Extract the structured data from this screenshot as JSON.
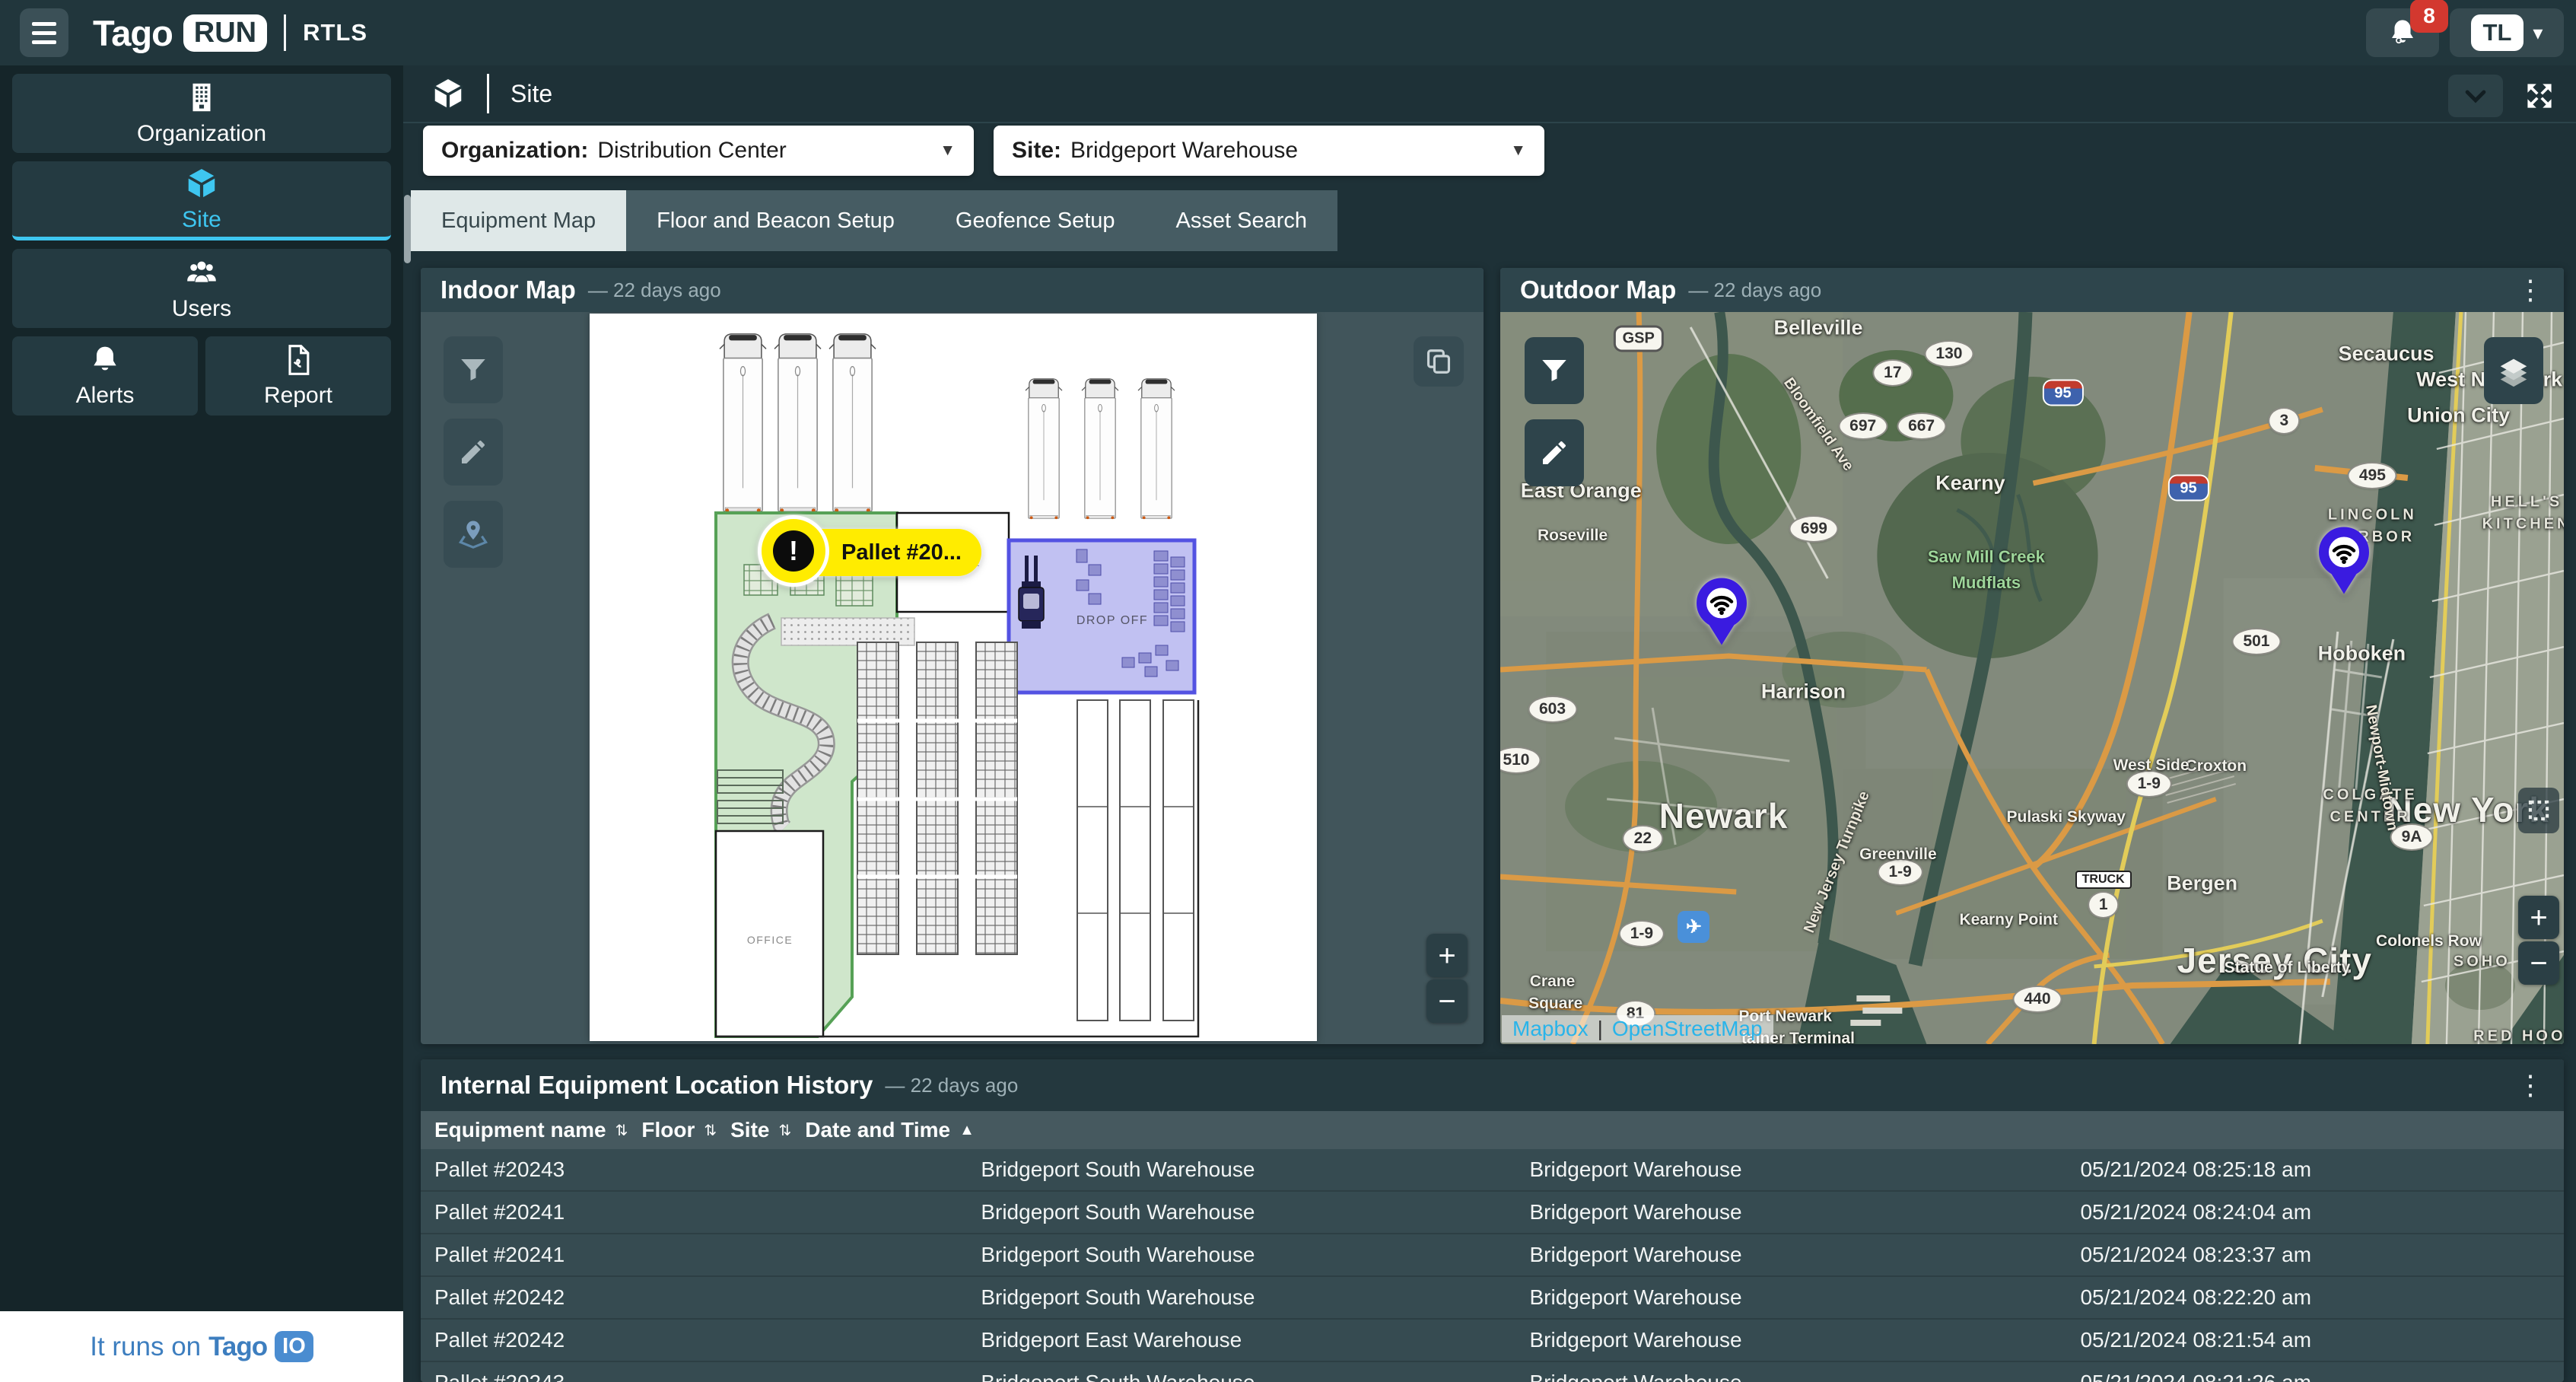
{
  "colors": {
    "accent_cyan": "#3ec6f0",
    "badge_red": "#d3382f",
    "pin_blue": "#3a1be0",
    "tago_blue": "#3d7ebf",
    "link_cyan": "#29b4ea",
    "zone_green": "#cfe6cb",
    "zone_purple": "#b6b6ef",
    "alert_yellow": "#ffec00"
  },
  "icons": {
    "kebab": "⋮",
    "caret_down": "▾",
    "dd_caret": "▼"
  },
  "topbar": {
    "logo_text": "Tago",
    "logo_badge": "RUN",
    "product": "RTLS",
    "notif_count": "8",
    "user_initials": "TL"
  },
  "sidebar": {
    "items": [
      {
        "label": "Organization"
      },
      {
        "label": "Site"
      },
      {
        "label": "Users"
      }
    ],
    "alerts_label": "Alerts",
    "report_label": "Report",
    "footer": {
      "prefix": "It runs on",
      "brand": "Tago",
      "badge": "IO"
    }
  },
  "header": {
    "title": "Site"
  },
  "filters": {
    "org_label": "Organization:",
    "org_value": "Distribution Center",
    "site_label": "Site:",
    "site_value": "Bridgeport Warehouse"
  },
  "tabs": [
    {
      "label": "Equipment Map",
      "cls": "active"
    },
    {
      "label": "Floor and Beacon Setup"
    },
    {
      "label": "Geofence Setup"
    },
    {
      "label": "Asset Search"
    }
  ],
  "indoor": {
    "title": "Indoor Map",
    "updated": "— 22 days ago",
    "alert_label": "Pallet #20...",
    "zones": {
      "loading": "LOADING",
      "lounge": "LOUNGE",
      "dropoff": "DROP OFF",
      "office": "OFFICE"
    },
    "zoom_in": "+",
    "zoom_out": "−"
  },
  "outdoor": {
    "title": "Outdoor Map",
    "updated": "— 22 days ago",
    "attribution": {
      "a": "Mapbox",
      "sep": "|",
      "b": "OpenStreetMap"
    },
    "zoom_in": "+",
    "zoom_out": "−",
    "pins": [
      {
        "x": 20.8,
        "y": 44.4
      },
      {
        "x": 79.3,
        "y": 37.4
      }
    ],
    "labels": [
      {
        "text": "GSP",
        "x": 13,
        "y": 3.6,
        "cls": "gsp"
      },
      {
        "text": "Belleville",
        "x": 29.9,
        "y": 2.2,
        "cls": "place"
      },
      {
        "text": "130",
        "x": 42.2,
        "y": 5.7,
        "cls": "shield"
      },
      {
        "text": "17",
        "x": 36.9,
        "y": 8.3,
        "cls": "shield"
      },
      {
        "text": "95",
        "x": 52.9,
        "y": 11,
        "cls": "interstate"
      },
      {
        "text": "Secaucus",
        "x": 83.3,
        "y": 5.7,
        "cls": "place"
      },
      {
        "text": "West New York",
        "x": 93,
        "y": 9.3,
        "cls": "place"
      },
      {
        "text": "Union City",
        "x": 90.1,
        "y": 14.1,
        "cls": "place"
      },
      {
        "text": "3",
        "x": 73.7,
        "y": 14.9,
        "cls": "shield"
      },
      {
        "text": "667",
        "x": 39.6,
        "y": 15.6,
        "cls": "shield"
      },
      {
        "text": "697",
        "x": 34.1,
        "y": 15.6,
        "cls": "shield"
      },
      {
        "text": "East Orange",
        "x": 7.6,
        "y": 24.4,
        "cls": "place"
      },
      {
        "text": "Kearny",
        "x": 44.2,
        "y": 23.4,
        "cls": "place"
      },
      {
        "text": "95",
        "x": 64.7,
        "y": 24,
        "cls": "interstate"
      },
      {
        "text": "495",
        "x": 82,
        "y": 22.3,
        "cls": "shield"
      },
      {
        "text": "LINCOLN",
        "x": 82,
        "y": 27.8,
        "cls": "caps"
      },
      {
        "text": "HARBOR",
        "x": 82,
        "y": 30.8,
        "cls": "caps"
      },
      {
        "text": "HELL'S",
        "x": 96.5,
        "y": 26,
        "cls": "caps"
      },
      {
        "text": "KITCHEN",
        "x": 96.5,
        "y": 29,
        "cls": "caps"
      },
      {
        "text": "699",
        "x": 29.5,
        "y": 29.6,
        "cls": "shield"
      },
      {
        "text": "Roseville",
        "x": 6.8,
        "y": 30.6,
        "cls": "place-sm"
      },
      {
        "text": "Saw Mill Creek",
        "x": 45.7,
        "y": 33.5,
        "cls": "water-label"
      },
      {
        "text": "Mudflats",
        "x": 45.7,
        "y": 37,
        "cls": "water-label"
      },
      {
        "text": "Bloomfield Ave",
        "x": 29.9,
        "y": 15.4,
        "cls": "road-label",
        "rot": 55
      },
      {
        "text": "Harrison",
        "x": 28.5,
        "y": 51.9,
        "cls": "place"
      },
      {
        "text": "Newark",
        "x": 21,
        "y": 68.8,
        "cls": "place-lg"
      },
      {
        "text": "501",
        "x": 71.1,
        "y": 45,
        "cls": "shield"
      },
      {
        "text": "1-9",
        "x": 61,
        "y": 64.4,
        "cls": "shield"
      },
      {
        "text": "1-9",
        "x": 37.6,
        "y": 76.5,
        "cls": "shield"
      },
      {
        "text": "1-9",
        "x": 13.3,
        "y": 84.9,
        "cls": "shield"
      },
      {
        "text": "Croxton",
        "x": 67.3,
        "y": 62.1,
        "cls": "place-sm"
      },
      {
        "text": "Pulaski Skyway",
        "x": 53.2,
        "y": 69,
        "cls": "place-sm"
      },
      {
        "text": "TRUCK",
        "x": 56.7,
        "y": 77.5,
        "cls": "truckshield"
      },
      {
        "text": "1",
        "x": 56.7,
        "y": 81,
        "cls": "shield"
      },
      {
        "text": "Kearny Point",
        "x": 47.8,
        "y": 83.1,
        "cls": "place-sm"
      },
      {
        "text": "Bergen",
        "x": 66,
        "y": 78.1,
        "cls": "place"
      },
      {
        "text": "Jersey City",
        "x": 72.8,
        "y": 88.6,
        "cls": "place-lg"
      },
      {
        "text": "Hoboken",
        "x": 81,
        "y": 46.7,
        "cls": "place"
      },
      {
        "text": "New York",
        "x": 91,
        "y": 68,
        "cls": "place-lg"
      },
      {
        "text": "COLGATE",
        "x": 81.8,
        "y": 66,
        "cls": "caps"
      },
      {
        "text": "CENTER",
        "x": 81.8,
        "y": 69,
        "cls": "caps"
      },
      {
        "text": "West Side",
        "x": 61.2,
        "y": 62,
        "cls": "place-sm"
      },
      {
        "text": "Greenville",
        "x": 37.4,
        "y": 74.1,
        "cls": "place-sm"
      },
      {
        "text": "22",
        "x": 13.4,
        "y": 71.9,
        "cls": "shield"
      },
      {
        "text": "603",
        "x": 4.9,
        "y": 54.3,
        "cls": "shield"
      },
      {
        "text": "510",
        "x": 1.5,
        "y": 61.2,
        "cls": "shield"
      },
      {
        "text": "440",
        "x": 50.5,
        "y": 93.9,
        "cls": "shield"
      },
      {
        "text": "Statue of Liberty",
        "x": 74,
        "y": 89.6,
        "cls": "place-sm"
      },
      {
        "text": "Colonels Row",
        "x": 87.3,
        "y": 86,
        "cls": "place-sm"
      },
      {
        "text": "Crane",
        "x": 4.9,
        "y": 91.5,
        "cls": "place-sm"
      },
      {
        "text": "Square",
        "x": 5.2,
        "y": 94.5,
        "cls": "place-sm"
      },
      {
        "text": "✈",
        "x": 18.2,
        "y": 84,
        "cls": "airport"
      },
      {
        "text": "Port Newark",
        "x": 26.8,
        "y": 96.3,
        "cls": "place-sm"
      },
      {
        "text": "tainer Terminal",
        "x": 28,
        "y": 99.3,
        "cls": "place-sm"
      },
      {
        "text": "81",
        "x": 12.7,
        "y": 95.8,
        "cls": "shield"
      },
      {
        "text": "9A",
        "x": 85.7,
        "y": 71.7,
        "cls": "shield"
      },
      {
        "text": "SOHO",
        "x": 92.3,
        "y": 88.8,
        "cls": "caps"
      },
      {
        "text": "RED HOOK",
        "x": 96.5,
        "y": 99,
        "cls": "caps"
      },
      {
        "text": "Newport-Midtown",
        "x": 82.8,
        "y": 62.3,
        "cls": "road-label",
        "rot": 80
      },
      {
        "text": "New Jersey Turnpike",
        "x": 31.7,
        "y": 75.2,
        "cls": "road-label",
        "rot": -68
      }
    ]
  },
  "table": {
    "title": "Internal Equipment Location History",
    "updated": "— 22 days ago",
    "columns": [
      {
        "label": "Equipment name",
        "sort": "⇅"
      },
      {
        "label": "Floor",
        "sort": "⇅"
      },
      {
        "label": "Site",
        "sort": "⇅"
      },
      {
        "label": "Date and Time",
        "sort": "▲"
      }
    ],
    "rows": [
      {
        "equipment": "Pallet #20243",
        "floor": "Bridgeport South Warehouse",
        "site": "Bridgeport Warehouse",
        "datetime": "05/21/2024 08:25:18 am"
      },
      {
        "equipment": "Pallet #20241",
        "floor": "Bridgeport South Warehouse",
        "site": "Bridgeport Warehouse",
        "datetime": "05/21/2024 08:24:04 am"
      },
      {
        "equipment": "Pallet #20241",
        "floor": "Bridgeport South Warehouse",
        "site": "Bridgeport Warehouse",
        "datetime": "05/21/2024 08:23:37 am"
      },
      {
        "equipment": "Pallet #20242",
        "floor": "Bridgeport South Warehouse",
        "site": "Bridgeport Warehouse",
        "datetime": "05/21/2024 08:22:20 am"
      },
      {
        "equipment": "Pallet #20242",
        "floor": "Bridgeport East Warehouse",
        "site": "Bridgeport Warehouse",
        "datetime": "05/21/2024 08:21:54 am"
      },
      {
        "equipment": "Pallet #20243",
        "floor": "Bridgeport South Warehouse",
        "site": "Bridgeport Warehouse",
        "datetime": "05/21/2024 08:21:26 am"
      }
    ]
  }
}
